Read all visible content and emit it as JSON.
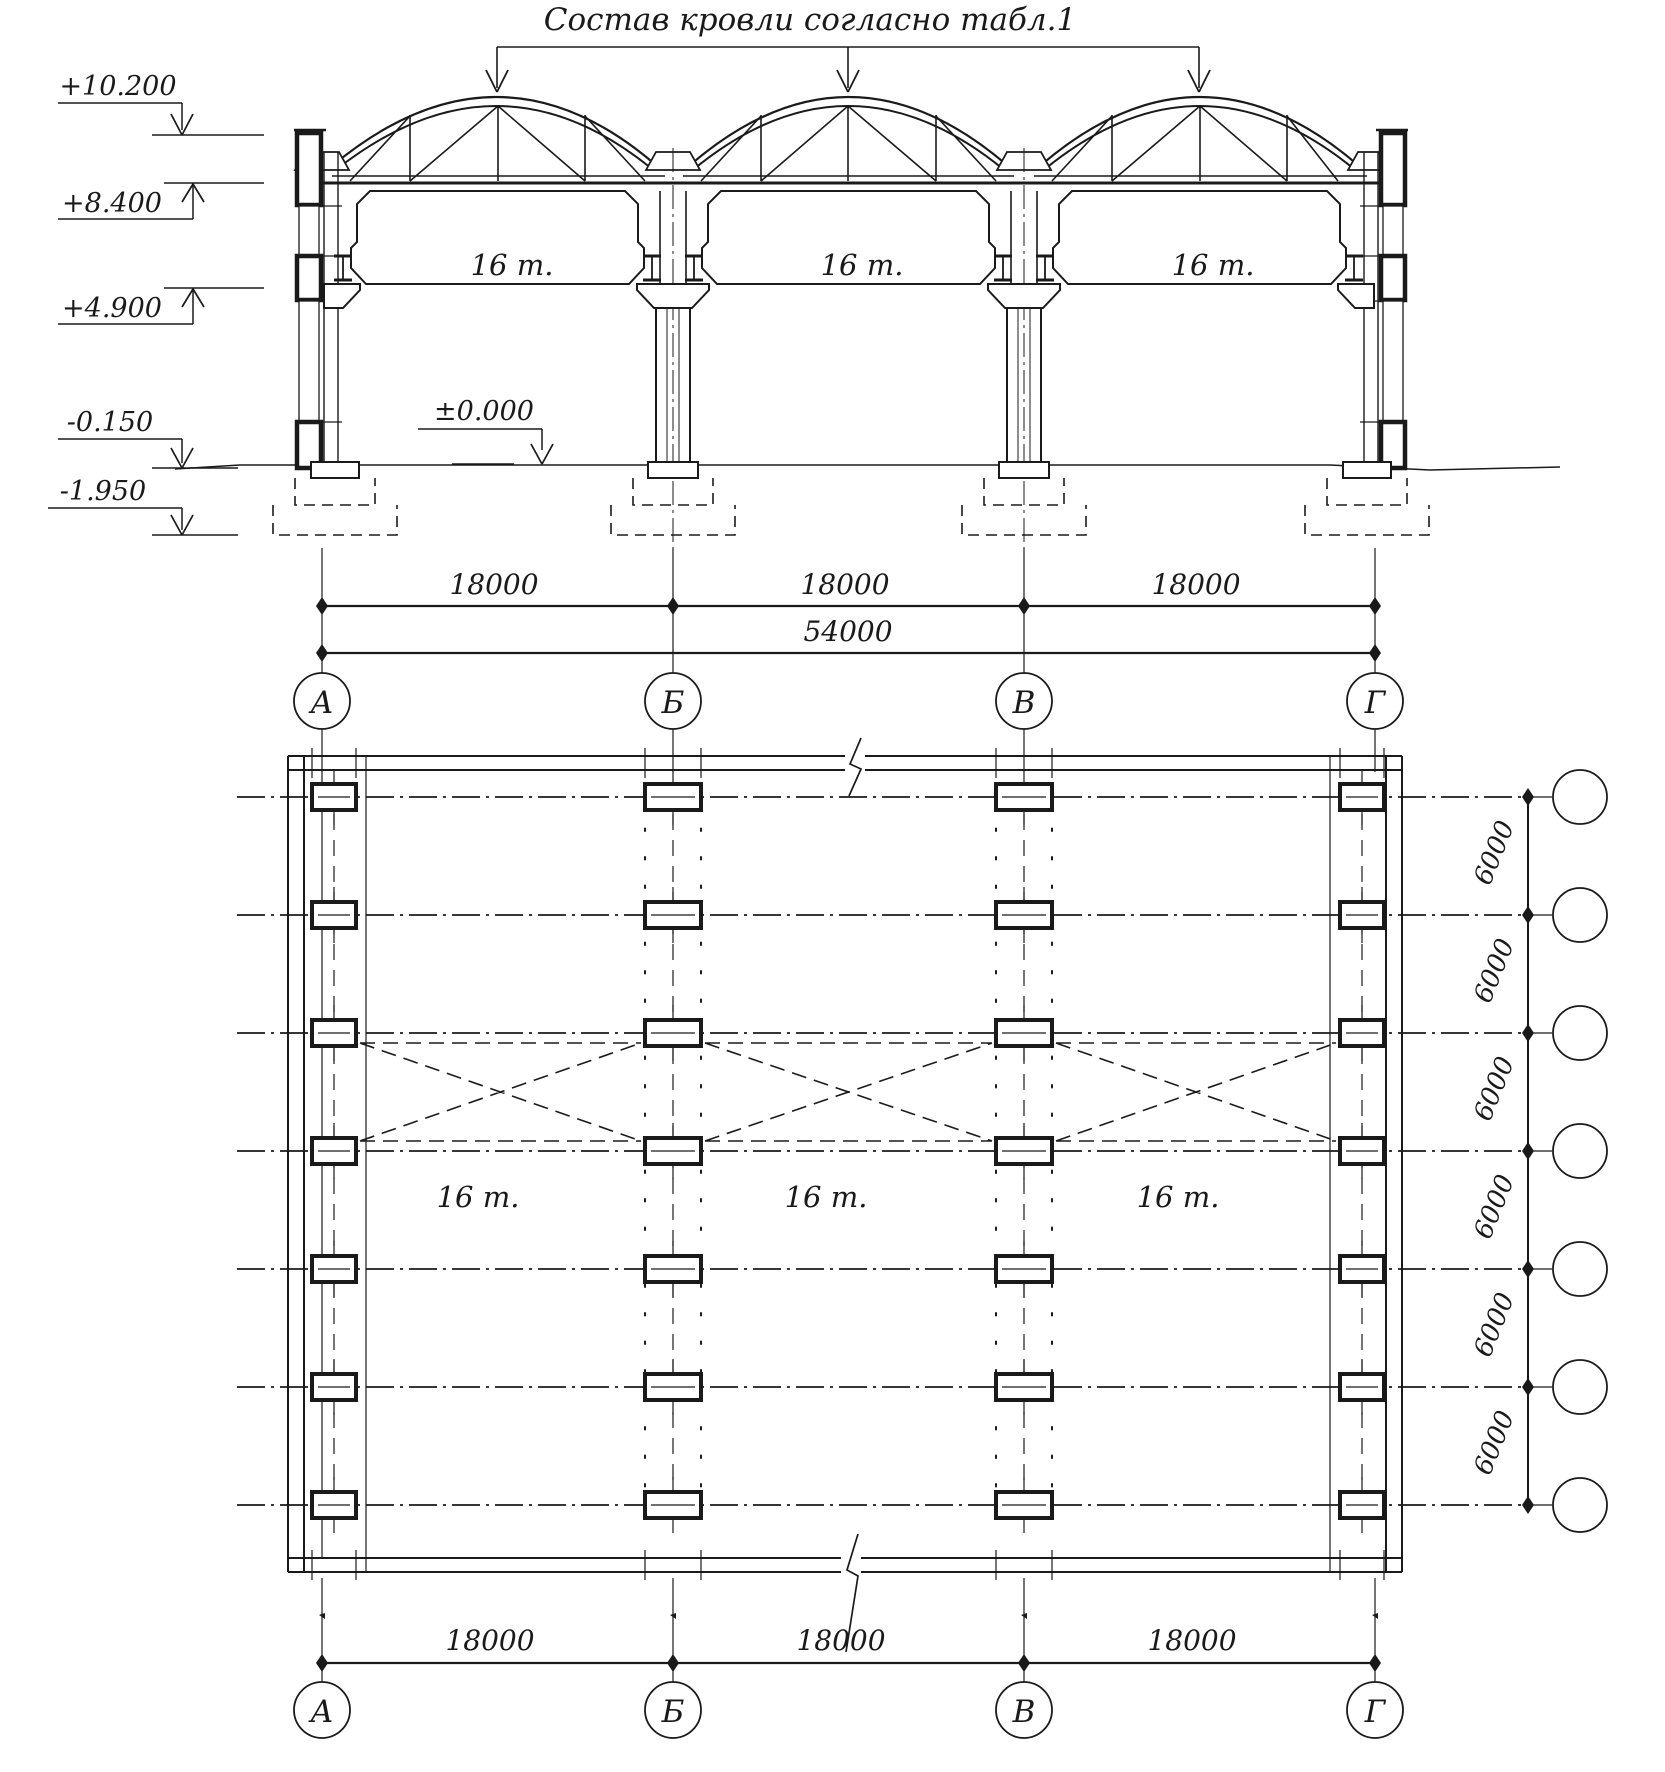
{
  "title": "Состав кровли согласно табл.1",
  "section": {
    "elevations": [
      "+10.200",
      "+8.400",
      "+4.900",
      "-0.150",
      "-1.950"
    ],
    "zero_mark": "±0.000",
    "crane_labels": [
      "16 т.",
      "16 т.",
      "16 т."
    ],
    "span_dims": [
      "18000",
      "18000",
      "18000"
    ],
    "total_dim": "54000",
    "axes": [
      "А",
      "Б",
      "В",
      "Г"
    ]
  },
  "plan": {
    "crane_labels": [
      "16 т.",
      "16 т.",
      "16 т."
    ],
    "span_dims": [
      "18000",
      "18000",
      "18000"
    ],
    "row_dims": [
      "6000",
      "6000",
      "6000",
      "6000",
      "6000",
      "6000"
    ],
    "axes": [
      "А",
      "Б",
      "В",
      "Г"
    ],
    "row_count": 7
  },
  "colors": {
    "ink": "#1a1a1a",
    "paper": "#ffffff"
  }
}
